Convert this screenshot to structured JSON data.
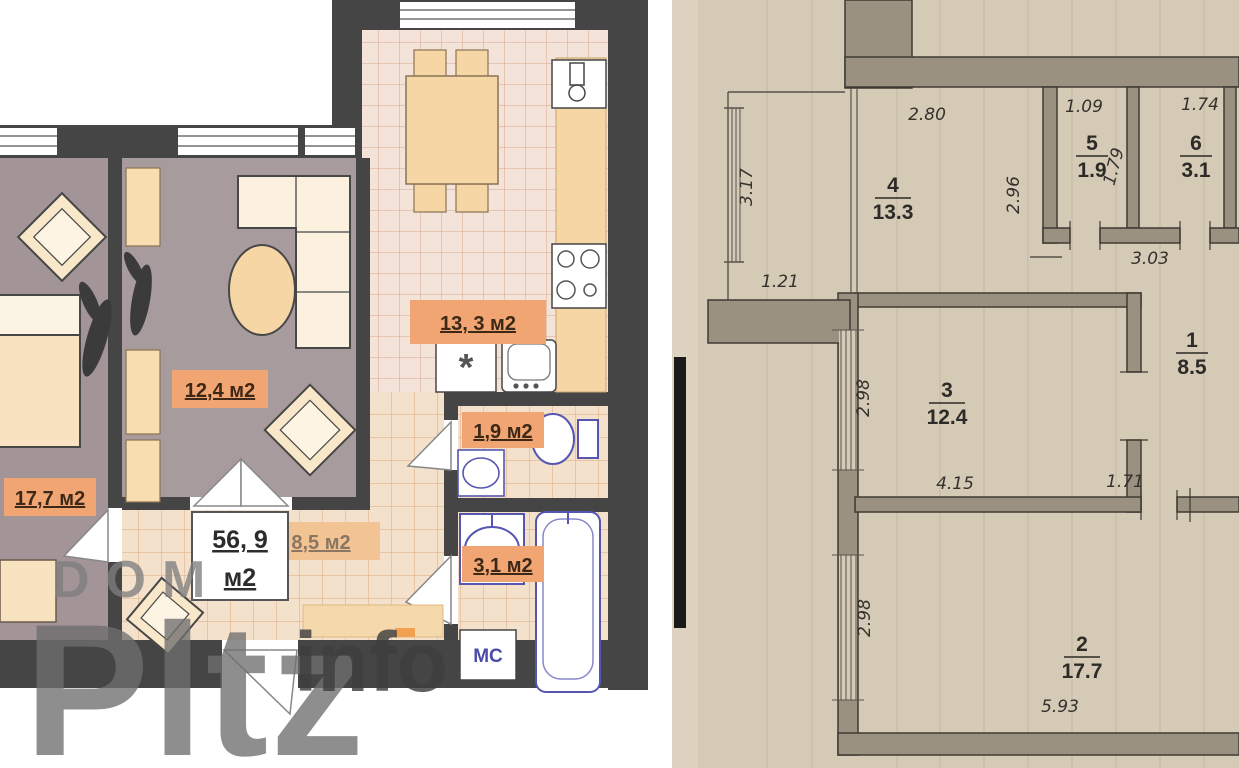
{
  "watermark": {
    "line1": "DOM",
    "line2": "Pltz",
    "line3": "info"
  },
  "left_plan": {
    "total_area": {
      "value": "56, 9",
      "unit": "м2"
    },
    "rooms": [
      {
        "id": "bedroom",
        "area_label": "17,7 м2"
      },
      {
        "id": "living",
        "area_label": "12,4 м2"
      },
      {
        "id": "kitchen",
        "area_label": "13, 3 м2"
      },
      {
        "id": "wc",
        "area_label": "1,9 м2"
      },
      {
        "id": "bathroom",
        "area_label": "3,1 м2"
      },
      {
        "id": "hallway",
        "area_label": "8,5 м2"
      }
    ],
    "appliances": {
      "washing_machine": "МС"
    }
  },
  "right_plan": {
    "rooms": [
      {
        "number": "1",
        "area": "8.5"
      },
      {
        "number": "2",
        "area": "17.7"
      },
      {
        "number": "3",
        "area": "12.4"
      },
      {
        "number": "4",
        "area": "13.3"
      },
      {
        "number": "5",
        "area": "1.9"
      },
      {
        "number": "6",
        "area": "3.1"
      }
    ],
    "dimensions": {
      "room4_width": "2.80",
      "room5_width": "1.09",
      "room6_width": "1.74",
      "balcony_height": "3.17",
      "balcony_width": "1.21",
      "room4_height": "2.96",
      "room5_height": "1.79",
      "corridor_width": "3.03",
      "room3_height": "2.98",
      "room3_width": "4.15",
      "hall_opening": "1.71",
      "room2_height": "2.98",
      "room2_width": "5.93"
    }
  },
  "colors": {
    "wall_dark": "#454545",
    "badge_orange": "#f0a572",
    "paper_beige": "#d5cab6",
    "plan_wall_fill": "#9b9180",
    "fixture_blue": "#5656b0",
    "floor_mauve": "#a59799"
  }
}
